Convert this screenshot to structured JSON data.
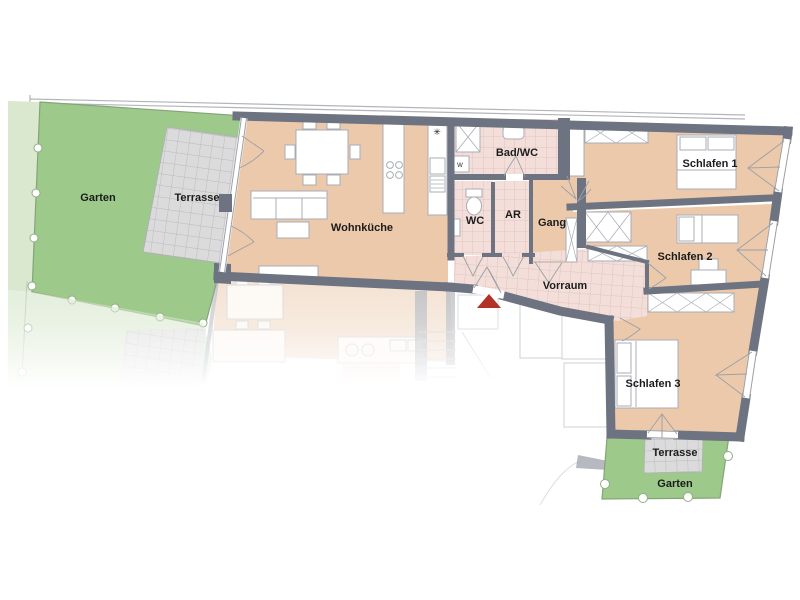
{
  "plan": {
    "type": "apartment-floor-plan",
    "rooms": [
      {
        "id": "garten-left",
        "label": "Garten"
      },
      {
        "id": "terrasse-left",
        "label": "Terrasse"
      },
      {
        "id": "wohnkueche",
        "label": "Wohnküche"
      },
      {
        "id": "bad-wc",
        "label": "Bad/WC"
      },
      {
        "id": "wc",
        "label": "WC"
      },
      {
        "id": "ar",
        "label": "AR"
      },
      {
        "id": "gang",
        "label": "Gang"
      },
      {
        "id": "schlafen-1",
        "label": "Schlafen 1"
      },
      {
        "id": "schlafen-2",
        "label": "Schlafen 2"
      },
      {
        "id": "vorraum",
        "label": "Vorraum"
      },
      {
        "id": "schlafen-3",
        "label": "Schlafen 3"
      },
      {
        "id": "terrasse-bottom",
        "label": "Terrasse"
      },
      {
        "id": "garten-bottom",
        "label": "Garten"
      }
    ],
    "icons": {
      "sink_symbol": "✳",
      "washer_label": "W"
    },
    "colors": {
      "wall": "#6d7380",
      "floor_tan": "#ecc9ab",
      "tile_pink": "#f3ded9",
      "tile_gray": "#dcdcdd",
      "garden_green": "#9dc98b",
      "garden_light": "#d9e8cf",
      "entrance_marker": "#b23226"
    }
  }
}
